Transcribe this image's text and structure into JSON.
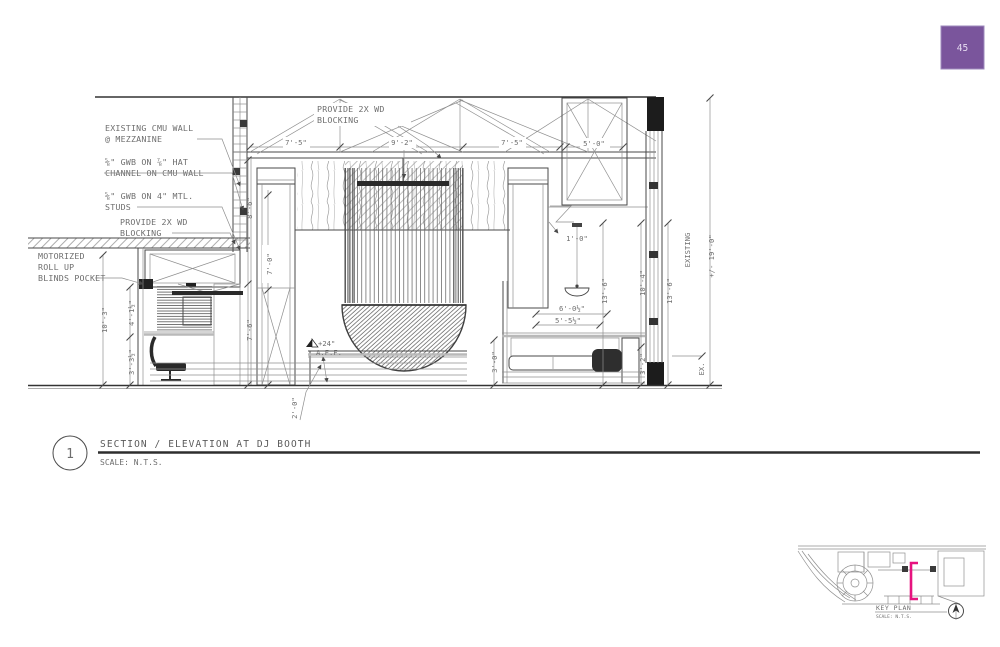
{
  "page": {
    "badge": "45"
  },
  "colors": {
    "accent": "#7a559c",
    "highlight": "#e6137f"
  },
  "titleblock": {
    "number": "1",
    "title": "SECTION / ELEVATION AT DJ BOOTH",
    "scale": "SCALE: N.T.S."
  },
  "keyplan": {
    "label": "KEY PLAN",
    "scale": "SCALE: N.T.S."
  },
  "callouts": {
    "cmu1": "EXISTING CMU WALL",
    "cmu2": "@ MEZZANINE",
    "hat1": "⅝\" GWB ON ⅞\" HAT",
    "hat2": "CHANNEL ON CMU WALL",
    "studs1": "⅝\" GWB ON 4\" MTL.",
    "studs2": "STUDS",
    "blk1": "PROVIDE 2X WD",
    "blk2": "BLOCKING",
    "blinds1": "MOTORIZED",
    "blinds2": "ROLL UP",
    "blinds3": "BLINDS POCKET",
    "topblk1": "PROVIDE 2X WD",
    "topblk2": "BLOCKING",
    "aff1": "+24\"",
    "aff2": "A.F.F.",
    "existing": "EXISTING",
    "ex": "EX."
  },
  "dims": {
    "top_left": "7'-5\"",
    "top_mid": "9'-2\"",
    "top_right": "7'-5\"",
    "box": "5'-0\"",
    "left_outer": "10'-3\"",
    "left_up": "4'-1½\"",
    "left_low": "3'-3½\"",
    "wall_up": "8'-6\"",
    "wall_low": "7'-6\"",
    "pilaster": "7'-0\"",
    "drop": "1'-0\"",
    "step": "2'-0\"",
    "banq_up": "6'-0½\"",
    "banq_low": "5'-5½\"",
    "banq_l": "3'-0\"",
    "banq_r": "3'-2\"",
    "right_a": "13'-6\"",
    "right_b": "10'-4\"",
    "right_c": "13'-6\"",
    "overall": "+/- 19'-0\""
  }
}
